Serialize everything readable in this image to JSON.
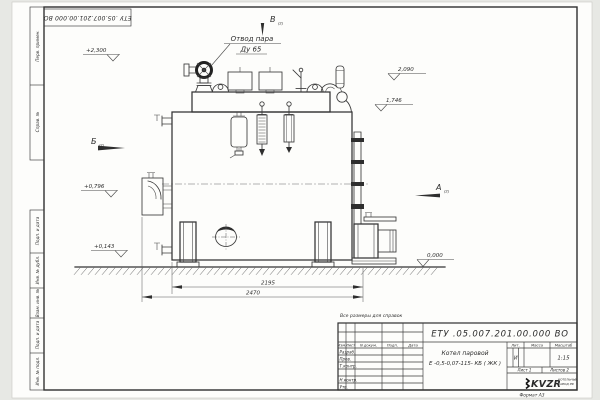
{
  "frame": {
    "top_stamp": "ЕТУ .05.007.201.00.000  ВО",
    "format_note": "Формат А3",
    "margin_top": [
      "Перв. примен.",
      "Справ. №"
    ],
    "margin_bottom": [
      "Подп. и дата",
      "Инв. № дубл.",
      "Взам. инв. №",
      "Подп. и дата",
      "Инв. № подл."
    ]
  },
  "callout": {
    "line1": "Отвод пара",
    "line2": "Ду 65"
  },
  "views": {
    "a": "А",
    "b": "Б",
    "v": "В",
    "sheet_ref": "(2)"
  },
  "elevations": {
    "top_left": "+2,300",
    "mid_left": "+0,796",
    "low_left": "+0,143",
    "top_right": "2,090",
    "mid_right": "1,746",
    "ground": "0,000"
  },
  "dimensions": {
    "inner": "2195",
    "outer": "2470"
  },
  "note": "Все размеры для справок",
  "title_block": {
    "doc_number": "ЕТУ .05.007.201.00.000  ВО",
    "product_name_line1": "Котел паровой",
    "product_name_line2": "Е -0,5-0,07-115- КБ ( ЖК )",
    "cols": [
      "Изм.",
      "Лист",
      "N докум.",
      "Подп.",
      "Дата"
    ],
    "rows": [
      "Разраб.",
      "Пров.",
      "Т.контр.",
      "",
      "Н.контр.",
      "Утв."
    ],
    "lit_label": "Лит.",
    "mass_label": "Масса",
    "scale_label": "Масштаб",
    "lit_value": "И",
    "scale_value": "1:15",
    "sheet_label": "Лист 1",
    "sheets_label": "Листов 2",
    "logo_text": "KVZR",
    "logo_caption_line1": "КОТЕЛЬНЫЙ",
    "logo_caption_line2": "ЗАВОД РФ"
  }
}
